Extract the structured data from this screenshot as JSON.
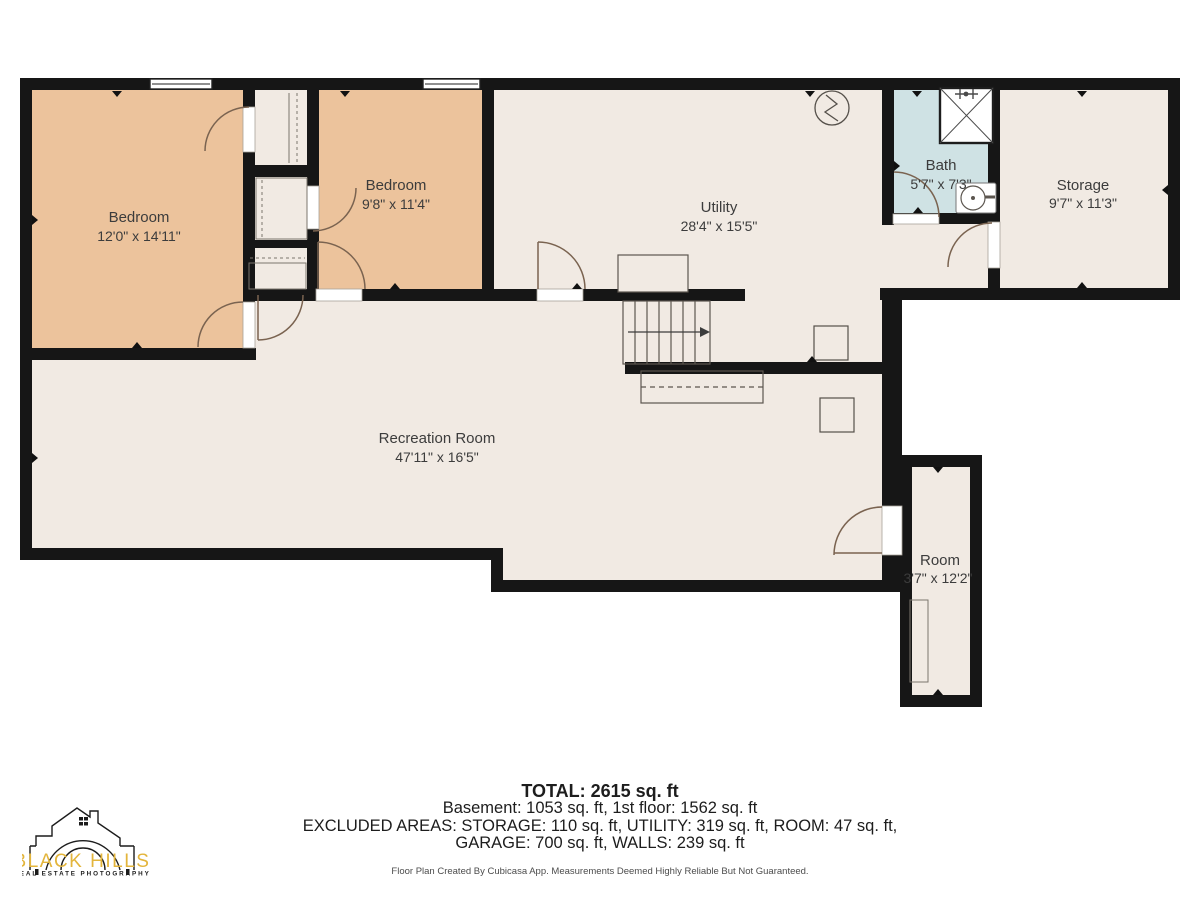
{
  "plan": {
    "rooms": [
      {
        "name": "Bedroom",
        "dims": "12'0\" x 14'11\""
      },
      {
        "name": "Bedroom",
        "dims": "9'8\" x 11'4\""
      },
      {
        "name": "Utility",
        "dims": "28'4\" x 15'5\""
      },
      {
        "name": "Bath",
        "dims": "5'7\" x 7'3\""
      },
      {
        "name": "Storage",
        "dims": "9'7\" x 11'3\""
      },
      {
        "name": "Recreation Room",
        "dims": "47'11\" x 16'5\""
      },
      {
        "name": "Room",
        "dims": "3'7\" x 12'2\""
      }
    ]
  },
  "summary": {
    "total": "TOTAL: 2615 sq. ft",
    "line2": "Basement: 1053 sq. ft, 1st floor: 1562 sq. ft",
    "line3": "EXCLUDED AREAS: STORAGE: 110 sq. ft, UTILITY: 319 sq. ft, ROOM: 47 sq. ft,",
    "line4": "GARAGE: 700 sq. ft, WALLS: 239 sq. ft"
  },
  "footer": {
    "disclaimer": "Floor Plan Created By Cubicasa App. Measurements Deemed Highly Reliable But Not Guaranteed."
  },
  "logo": {
    "brand": "BLACK HILLS",
    "tagline": "REAL ESTATE PHOTOGRAPHY"
  },
  "colors": {
    "floor_fill": "#f1eae3",
    "bedroom_fill": "#ecc39c",
    "bath_fill": "#cfe2e4",
    "wall": "#161616",
    "door_arc": "#7a6350",
    "logo_gold": "#e3b53c"
  }
}
